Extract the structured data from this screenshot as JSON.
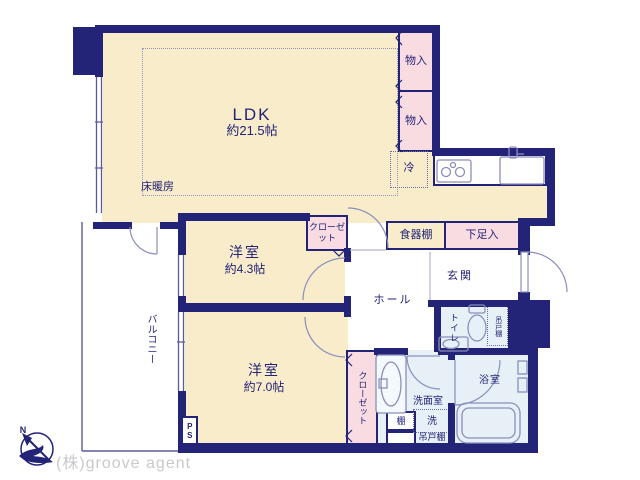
{
  "watermark": "(株)groove agent",
  "compass": {
    "north_label": "N"
  },
  "colors": {
    "wall": "#232377",
    "room_beige": "#f8ecca",
    "storage_pink": "#f9dce2",
    "wet_blue": "#e6f0f6",
    "fixture_line": "#8a8fbb",
    "watermark_gray": "#c9c9ce"
  },
  "rooms": {
    "ldk": {
      "name": "LDK",
      "size": "約21.5帖",
      "floor_heating": "床暖房"
    },
    "bedroom_small": {
      "name": "洋室",
      "size": "約4.3帖"
    },
    "bedroom_large": {
      "name": "洋室",
      "size": "約7.0帖"
    },
    "balcony": {
      "name": "バルコニー"
    },
    "hall": {
      "name": "ホール"
    },
    "entrance": {
      "name": "玄関"
    },
    "toilet": {
      "name": "トイレ",
      "hanging_cupboard": "吊戸棚"
    },
    "bathroom": {
      "name": "浴室"
    },
    "washroom": {
      "name": "洗面室",
      "washer": "洗",
      "hanging_cupboard": "吊戸棚",
      "shelf": "棚"
    }
  },
  "storage": {
    "storage_top": "物入",
    "storage_mid": "物入",
    "refrigerator": "冷",
    "dish_shelf": "食器棚",
    "shoe_cabinet": "下足入",
    "closet_small_bedroom": "クローゼット",
    "closet_large_bedroom": "クローゼット",
    "pipe_space": "PS"
  }
}
